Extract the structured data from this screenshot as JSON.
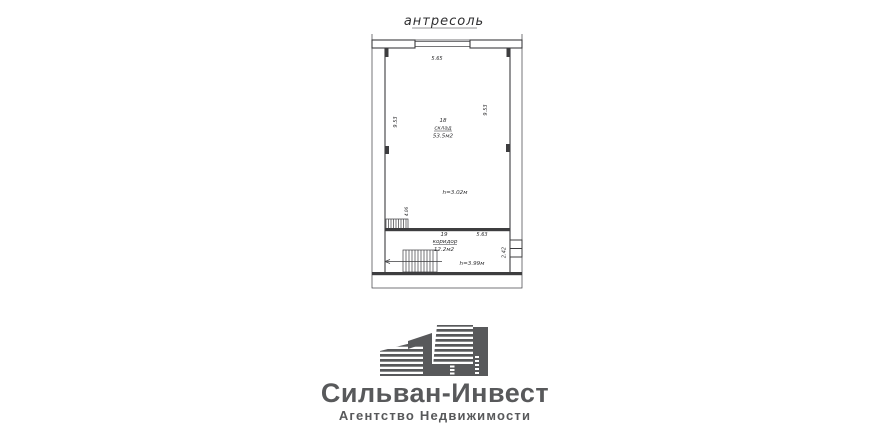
{
  "plan": {
    "title": "антресоль",
    "rooms": [
      {
        "number": "18",
        "name": "склад",
        "area": "53.5м2",
        "ceiling_height": "h=3.02м"
      },
      {
        "number": "19",
        "name": "коридор",
        "area": "12.2м2",
        "ceiling_height": "h=3.99м"
      }
    ],
    "dimensions": {
      "top_width": "5.65",
      "left_height": "9.53",
      "right_height": "9.53",
      "corridor_width": "5.63",
      "entry_depth": "2.42",
      "hatch": "4.06"
    }
  },
  "logo": {
    "company": "Сильван-Инвест",
    "tagline": "Агентство Недвижимости",
    "icon": "buildings-icon"
  },
  "colors": {
    "logo-gray": "#58595b",
    "plan-line": "#3d3d3f",
    "plan-text": "#2f2f31",
    "background": "#ffffff"
  }
}
